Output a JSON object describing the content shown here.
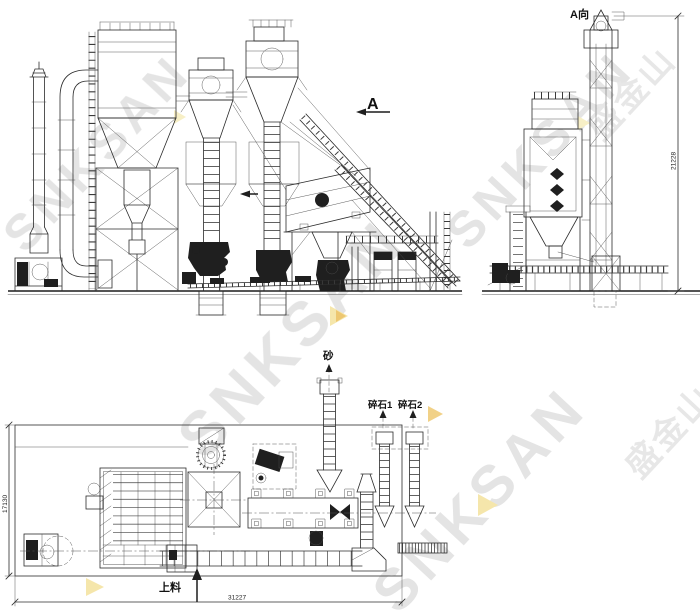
{
  "drawing": {
    "front_elevation": {
      "section_label": "A"
    },
    "side_view": {
      "title": "A向",
      "dim_height": "21228"
    },
    "plan_view": {
      "label_sand": "砂",
      "label_crushed_stone_1": "碎石1",
      "label_crushed_stone_2": "碎石2",
      "label_feed": "上料",
      "dim_width": "31227",
      "dim_depth": "17130"
    },
    "watermark": {
      "brand_latin": "SNKSAN",
      "brand_cn": "盛金山",
      "color_gray": "#dedede",
      "color_yellow": "#f3e096",
      "color_orange": "#e9b94e"
    },
    "colors": {
      "line": "#2b2b2b",
      "background": "#ffffff"
    }
  }
}
